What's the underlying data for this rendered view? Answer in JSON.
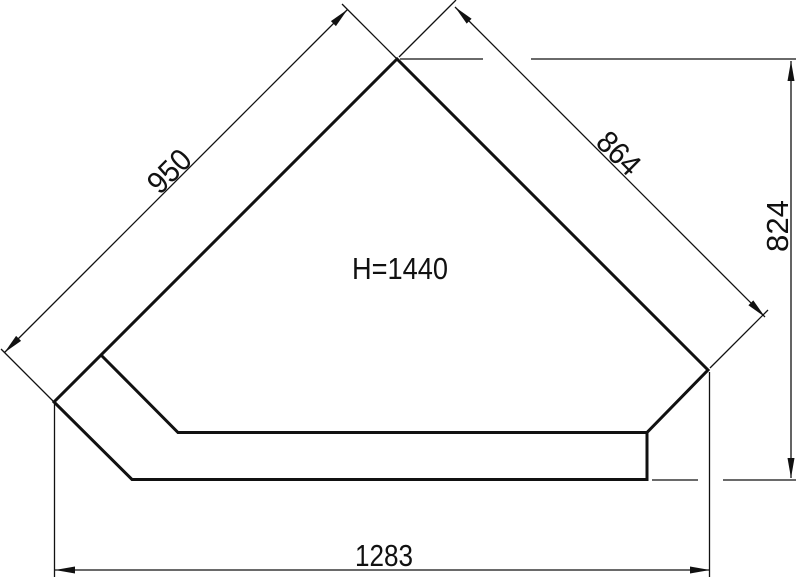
{
  "drawing": {
    "kind": "corner-bathtub-dimension-drawing",
    "center_label": "H=1440",
    "dimensions": {
      "left_edge": "950",
      "right_edge": "864",
      "right_height": "824",
      "bottom_width": "1283"
    },
    "colors": {
      "line": "#111111",
      "background": "#ffffff"
    }
  }
}
